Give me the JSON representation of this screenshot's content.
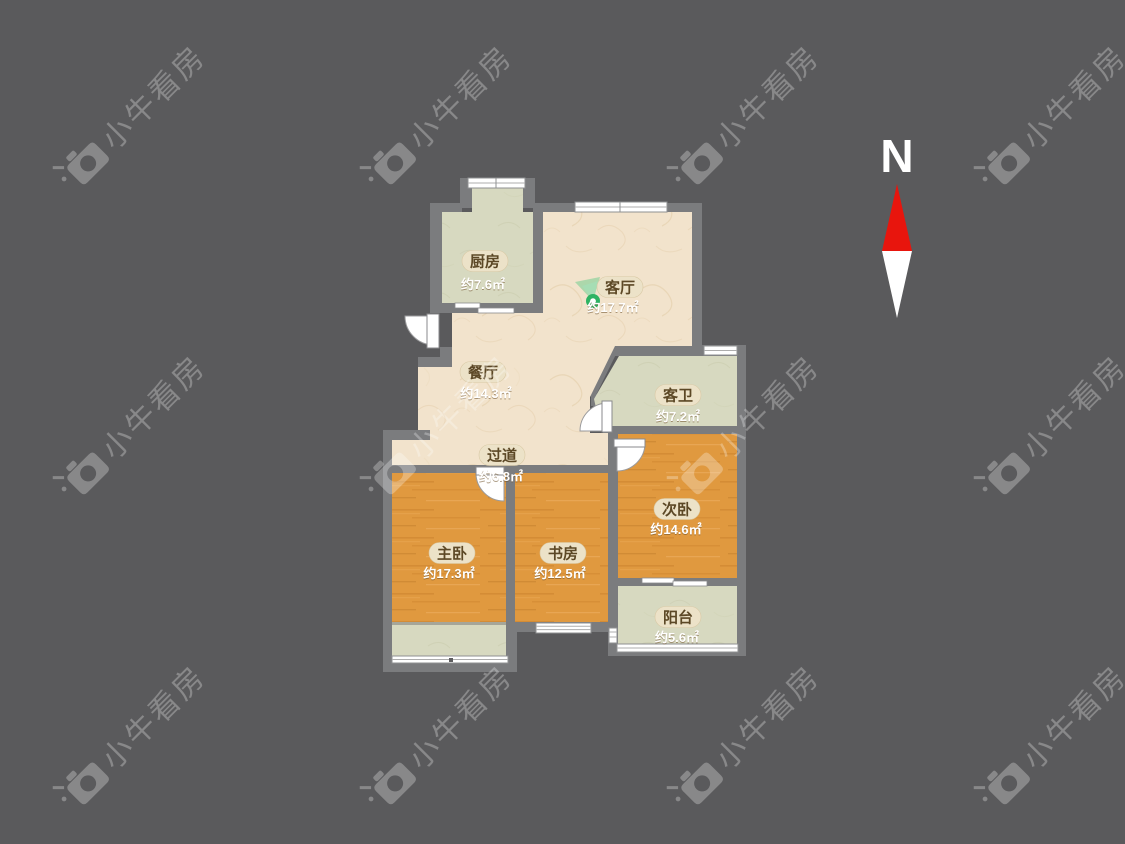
{
  "watermark": {
    "text": "小牛看房"
  },
  "compass": {
    "label": "N"
  },
  "rooms": [
    {
      "id": "kitchen",
      "name": "厨房",
      "area": "约7.6㎡"
    },
    {
      "id": "living-room",
      "name": "客厅",
      "area": "约17.7㎡"
    },
    {
      "id": "dining-room",
      "name": "餐厅",
      "area": "约14.3㎡"
    },
    {
      "id": "guest-bathroom",
      "name": "客卫",
      "area": "约7.2㎡"
    },
    {
      "id": "hallway",
      "name": "过道",
      "area": "约6.8㎡"
    },
    {
      "id": "master-bedroom",
      "name": "主卧",
      "area": "约17.3㎡"
    },
    {
      "id": "study",
      "name": "书房",
      "area": "约12.5㎡"
    },
    {
      "id": "second-bedroom",
      "name": "次卧",
      "area": "约14.6㎡"
    },
    {
      "id": "balcony",
      "name": "阳台",
      "area": "约5.6㎡"
    }
  ],
  "colors": {
    "background": "#5a5a5c",
    "wall": "#7b7c7e",
    "floor_beige": "#f2e3cc",
    "floor_sage": "#d7d9c0",
    "floor_wood": "#e0993f",
    "compass_red": "#e8150d",
    "marker_green": "#2eb363",
    "label_pill": "#ece2c8"
  }
}
